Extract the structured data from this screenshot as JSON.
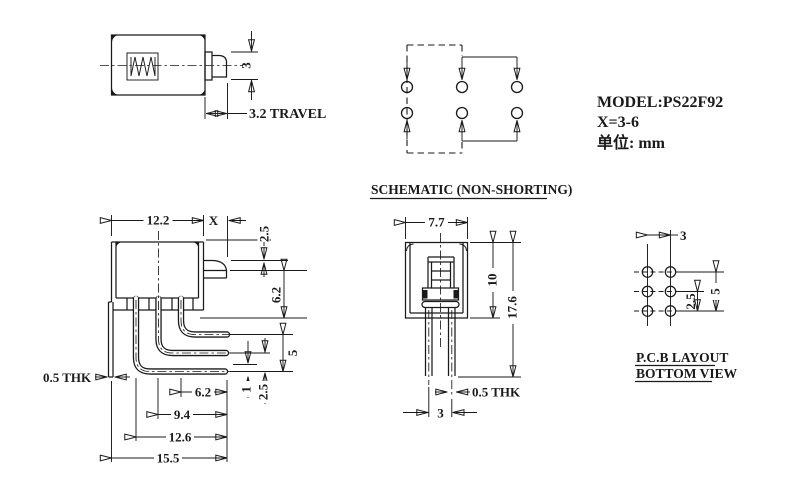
{
  "info": {
    "model": "MODEL:PS22F92",
    "x_value": "X=3-6",
    "unit": "单位: mm"
  },
  "top_view": {
    "actuator_height": "3",
    "travel": "3.2 TRAVEL"
  },
  "schematic": {
    "title": "SCHEMATIC (NON-SHORTING)"
  },
  "side_view": {
    "body_width": "12.2",
    "actuator_len": "X",
    "top_to_actuator": "2.5",
    "actuator_to_base": "6.2",
    "pin_span": "5",
    "pin_offset": "1",
    "pin_pitch": "2.5",
    "thickness": "0.5 THK",
    "pin_len_1": "6.2",
    "pin_len_2": "9.4",
    "pin_len_3": "12.6",
    "pin_len_4": "15.5"
  },
  "front_view": {
    "body_width": "7.7",
    "body_height": "10",
    "total_height": "17.6",
    "thickness": "0.5 THK",
    "pin_pitch": "3"
  },
  "pcb": {
    "col_pitch": "3",
    "row_pitch": "2.5",
    "row_span": "5",
    "title_line1": "P.C.B LAYOUT",
    "title_line2": "BOTTOM VIEW"
  }
}
